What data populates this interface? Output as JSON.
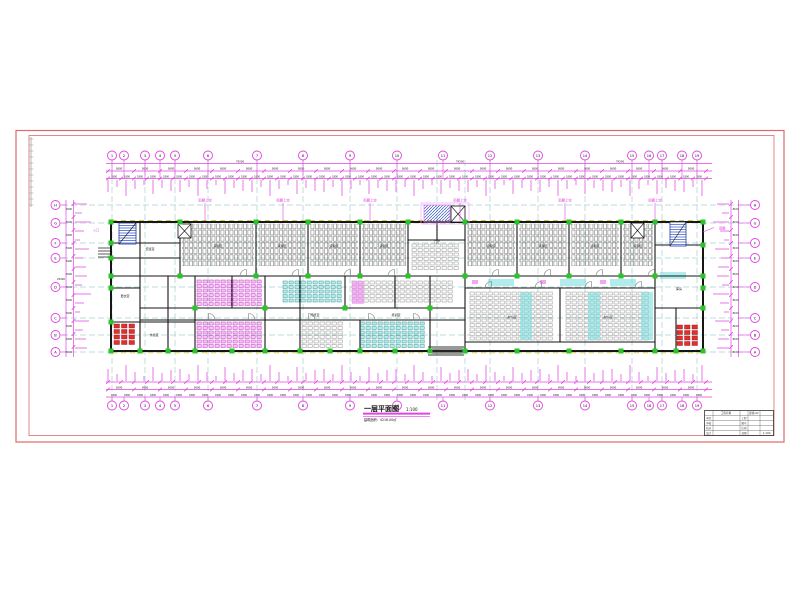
{
  "colors": {
    "frame": "#dd6a6a",
    "dim": "#e243e2",
    "dim_light": "#f0a8f0",
    "grid_line": "#a8cfcf",
    "yellow": "#d9c93f",
    "green": "#2bc42b",
    "cyan": "#7fdede",
    "magenta": "#ef7fef",
    "wall": "#161616",
    "red": "#e03030",
    "blue": "#2f55c8",
    "desk_gray": "#8f8f8f",
    "text": "#111111"
  },
  "grid": {
    "numbers": [
      "1",
      "2",
      "3",
      "4",
      "5",
      "6",
      "7",
      "8",
      "9",
      "10",
      "11",
      "12",
      "13",
      "14",
      "15",
      "16",
      "17",
      "18",
      "19"
    ],
    "letters": [
      "H",
      "G",
      "F",
      "E",
      "D",
      "C",
      "B",
      "A"
    ]
  },
  "dims": {
    "segment": "3600",
    "half": "1800",
    "overall": "79200",
    "side": "8100",
    "side_overall": "25200"
  },
  "annotations": {
    "canopy_labels": [
      "雨棚上空",
      "雨棚上空",
      "雨棚上空",
      "雨棚上空",
      "雨棚上空",
      "雨棚上空"
    ],
    "right_label": "雨棚",
    "left_label": "入口"
  },
  "rooms": {
    "bay_label": "货架区",
    "core": "门厅",
    "left_room_1": "值班室",
    "left_room_2": "更衣室",
    "left_room_3": "休息室",
    "open_office_left": "办公区",
    "open_office_right": "办公区",
    "training": "培训室",
    "reading": "阅览室",
    "store_right": "库房"
  },
  "title": {
    "main": "一层平面图",
    "scale": "1:100",
    "sub": "建筑面积：4216.00㎡"
  },
  "titleblock": {
    "left_labels": [
      "审定",
      "审核",
      "校对",
      "设计"
    ],
    "right_labels": [
      "工程",
      "图号",
      "比例",
      "日期"
    ],
    "project": "工程名称",
    "drawing_no": "建施-02",
    "scale_value": "1:100"
  }
}
